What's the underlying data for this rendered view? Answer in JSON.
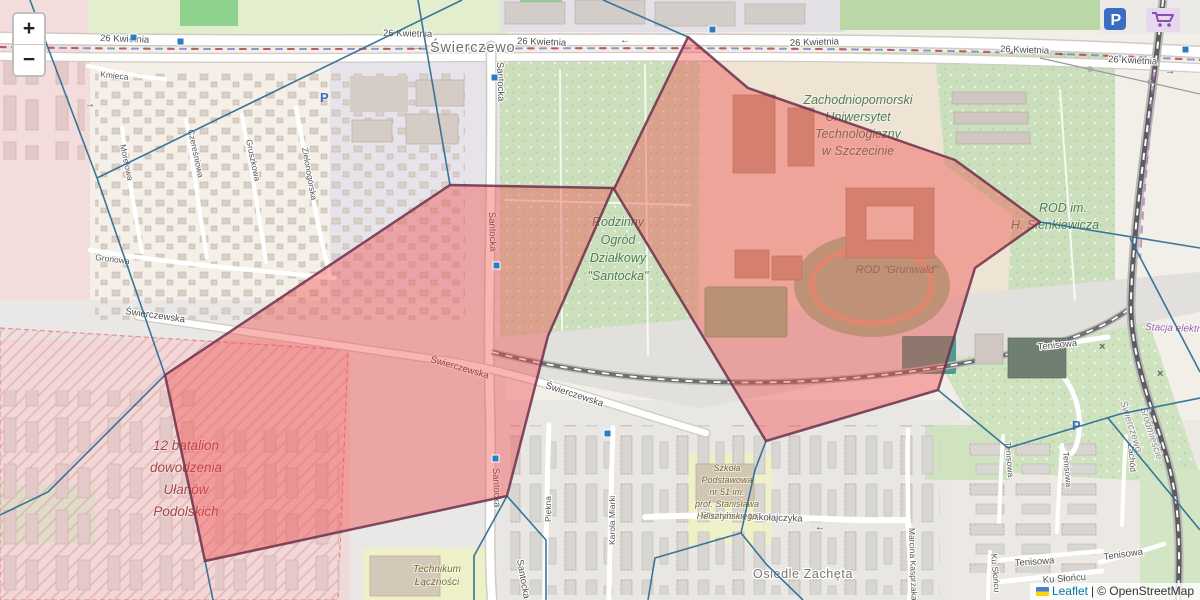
{
  "map": {
    "controls": {
      "zoom_in": "+",
      "zoom_out": "−"
    },
    "attribution": {
      "leaflet": "Leaflet",
      "separator": "|",
      "osm": "© OpenStreetMap"
    },
    "places": {
      "swierczewo": "Świerczewo",
      "osiedle_zacheta": "Osiedle Zachęta",
      "srodmiescie": "Śródmieście"
    },
    "streets": {
      "kwietnia": "26 Kwietnia",
      "santocka": "Santocka",
      "swierczewska": "Świerczewska",
      "kmieca": "Kmieca",
      "morelowa": "Morelowa",
      "czeresniowa": "Czereśniowa",
      "gruszkowa": "Gruszkowa",
      "zielonogorska": "Zielonogórska",
      "gronowa": "Gronowa",
      "piekna": "Piękna",
      "karola_miarki": "Karola Miarki",
      "mikolajczyka": "Stanisława Mikołajczyka",
      "kasprzaka": "Marcina Kasprzaka",
      "tenisowa": "Tenisowa",
      "ku_sloncu": "Ku Słońcu",
      "zachod": "Zachód"
    },
    "pois": {
      "university": [
        "Zachodniopomorski",
        "Uniwersytet",
        "Technologiczny",
        "w Szczecinie"
      ],
      "rod_santocka": [
        "Rodzinny",
        "Ogród",
        "Działkowy",
        "\"Santocka\""
      ],
      "rod_grunwald": "ROD \"Grunwald\"",
      "rod_sienkiewicza": [
        "ROD im.",
        "H. Sienkiewicza"
      ],
      "military": [
        "12 batalion",
        "dowodzenia",
        "Ułanów",
        "Podolskich"
      ],
      "school51": [
        "Szkoła",
        "Podstawowa",
        "nr 51 im.",
        "prof. Stanisława",
        "Helsztyńskiego"
      ],
      "technikum": [
        "Technikum",
        "Łączności"
      ],
      "stacja": "Stacja elektroen",
      "parking_letter": "P"
    },
    "glyphs": {
      "arrow_right": "→",
      "arrow_left": "←",
      "crossing": "×"
    },
    "colors": {
      "overlay_fill": "#ef4444",
      "overlay_stroke": "#6d2f4c",
      "mesh_stroke": "#2f6f93",
      "marker_blue": "#2b7cc2",
      "link_blue": "#0078A8",
      "land_green": "#cbdfbd",
      "military_red": "#aa4444",
      "poi_green": "#4e7e54",
      "parking_blue": "#3a6ec4"
    }
  }
}
